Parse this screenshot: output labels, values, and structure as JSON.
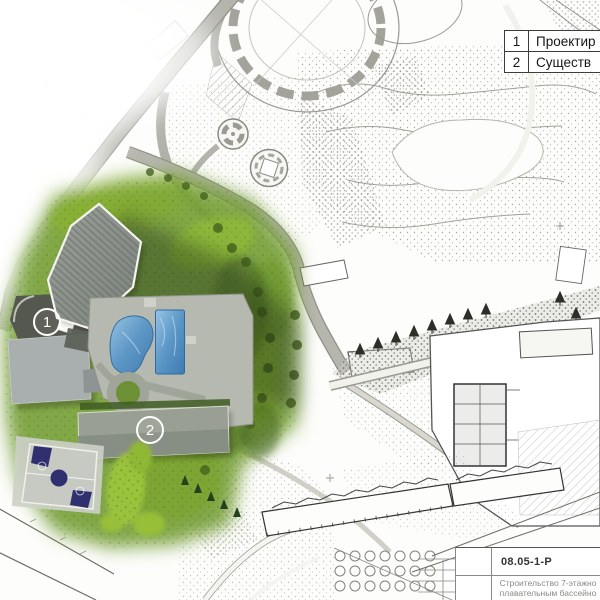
{
  "legend": {
    "rows": [
      {
        "num": "1",
        "label": "Проектир"
      },
      {
        "num": "2",
        "label": "Существ"
      }
    ]
  },
  "markers": [
    {
      "label": "1"
    },
    {
      "label": "2"
    }
  ],
  "title_block": {
    "code": "08.05-1-Р",
    "description_line1": "Строительство 7-этажно",
    "description_line2": "плавательным бассейно"
  },
  "colors": {
    "green_zone": "#76a036",
    "bright_foliage": "#9cc43d",
    "pool_water": "#4a86b8",
    "roof_gray": "#8b918b",
    "court_navy": "#303070",
    "plaza_dark": "#55584f",
    "marker_white": "#ffffff"
  }
}
